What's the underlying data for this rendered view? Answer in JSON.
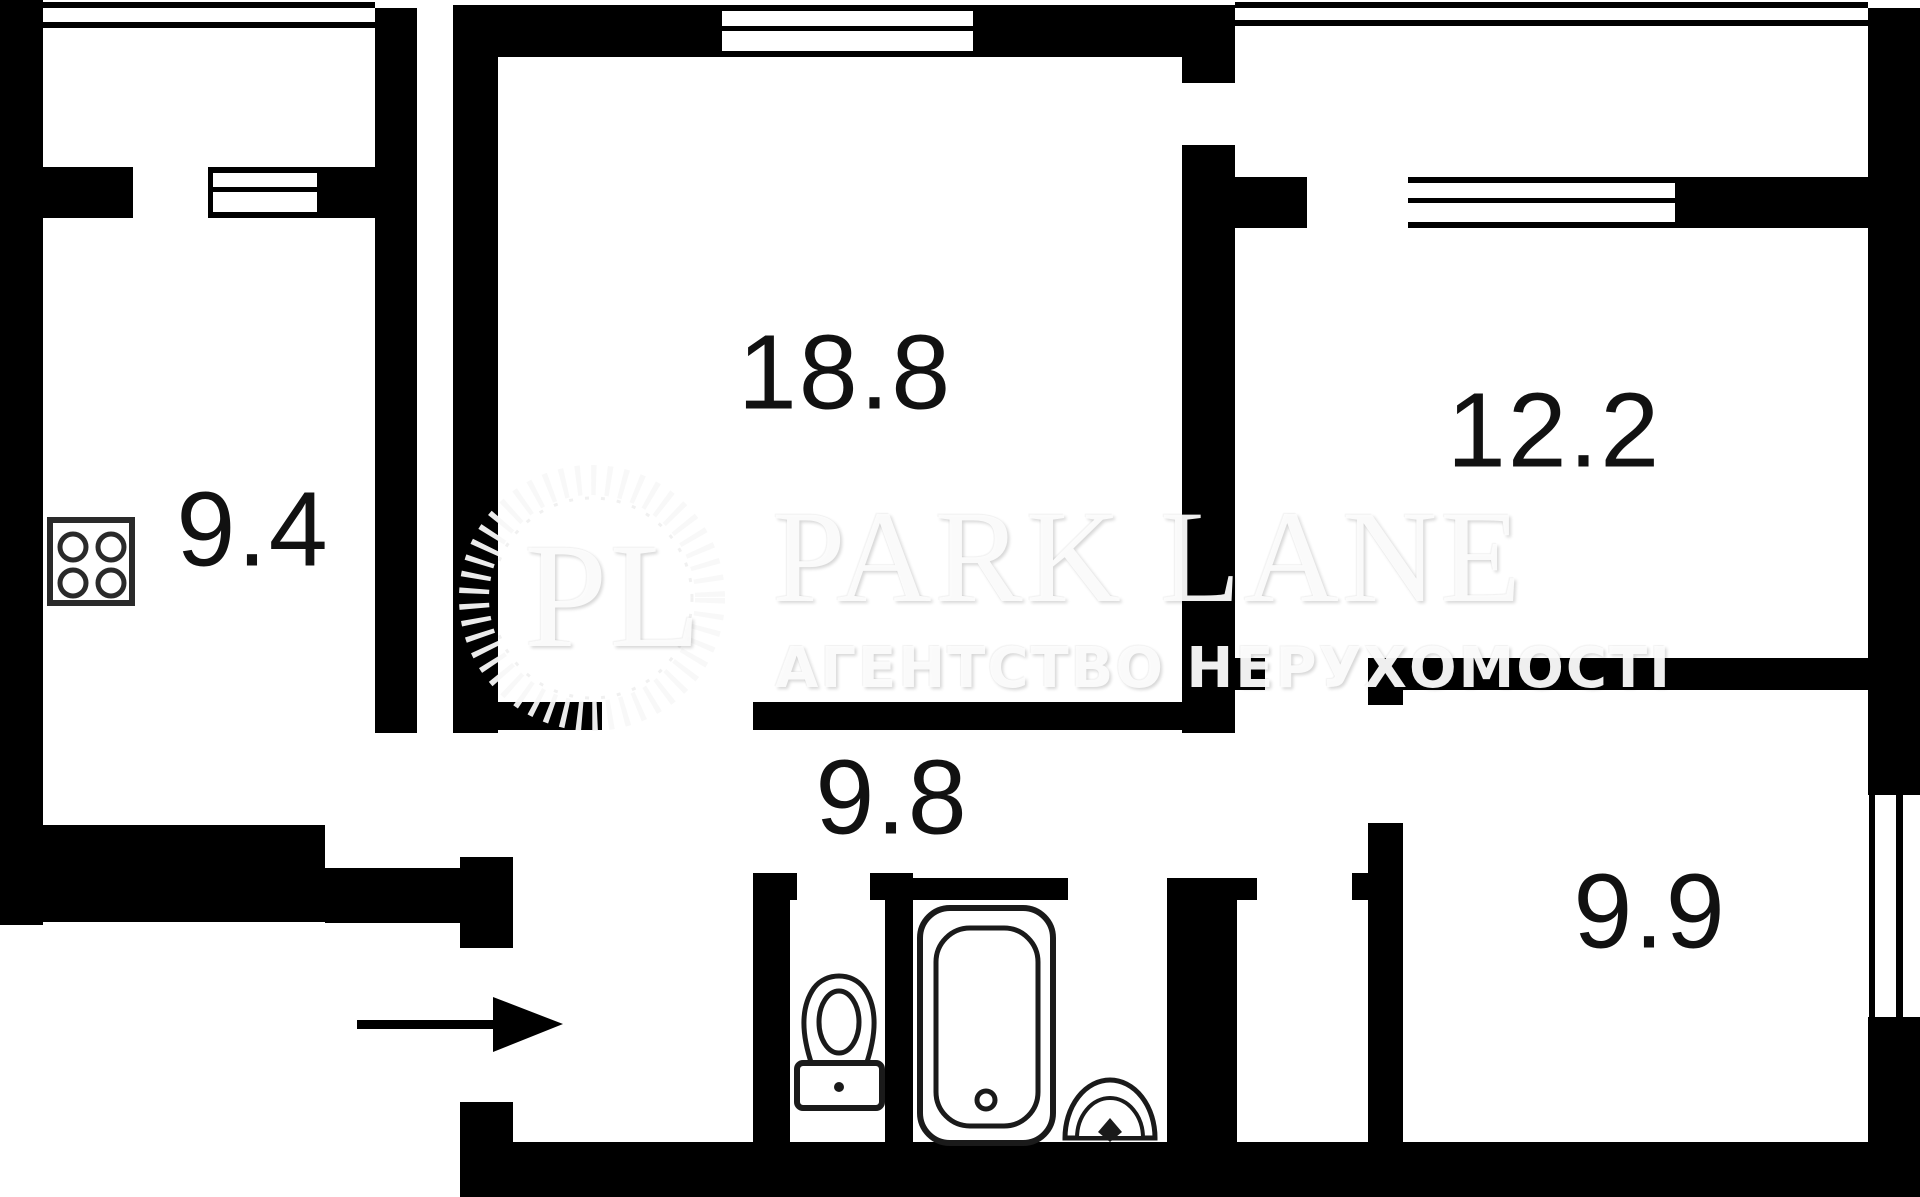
{
  "plan": {
    "title": "apartment-floor-plan",
    "rooms": [
      {
        "name": "kitchen",
        "area": "9.4"
      },
      {
        "name": "living-room",
        "area": "18.8"
      },
      {
        "name": "bedroom-top-right",
        "area": "12.2"
      },
      {
        "name": "hallway",
        "area": "9.8"
      },
      {
        "name": "bedroom-bottom-right",
        "area": "9.9"
      }
    ]
  },
  "watermark": {
    "logo_initials": "PL",
    "brand": "PARK LANE",
    "tagline": "АГЕНТСТВО НЕРУХОМОСТІ"
  },
  "colors": {
    "wall": "#000000",
    "background": "#ffffff",
    "label": "#111111",
    "watermark": "#f0f0f0"
  }
}
